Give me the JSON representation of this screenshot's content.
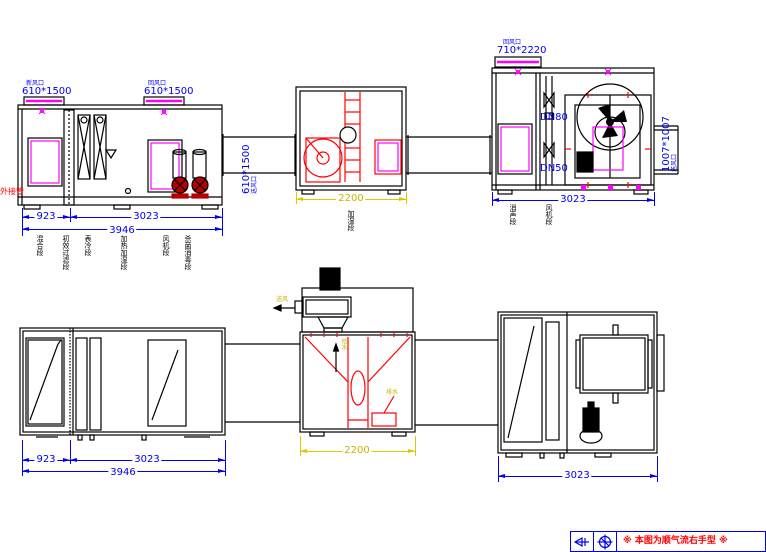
{
  "colors": {
    "dimension_blue": "#0000ee",
    "component_red": "#ff0000",
    "door_magenta": "#ff00ff",
    "dimension_yellow": "#ddc700",
    "pump_dark_red": "#b40000"
  },
  "elevation": {
    "left": {
      "vent1_name": "新风口",
      "vent1_size": "610*1500",
      "vent2_name": "回风口",
      "vent2_size": "610*1500",
      "duct_name": "送风口",
      "duct_size": "610*1500",
      "dim_a": "923",
      "dim_b": "3023",
      "dim_total": "3946",
      "side_note": "外接管",
      "sections": [
        "混合段",
        "初效过滤段",
        "表冷段",
        "加热加湿段",
        "风机段",
        "杀菌消毒段"
      ]
    },
    "middle": {
      "dim": "2200",
      "section": "加湿段"
    },
    "right": {
      "vent_name": "回风口",
      "vent_size": "710*2220",
      "pipe_top": "DN80",
      "pipe_bottom": "DN50",
      "outlet_name": "送风口",
      "outlet_size": "1007*1007",
      "dim": "3023",
      "sections": [
        "消声段",
        "风机段"
      ]
    }
  },
  "plan": {
    "left": {
      "dim_a": "923",
      "dim_b": "3023",
      "dim_total": "3946"
    },
    "middle": {
      "dim": "2200",
      "note_blower": "送风",
      "note_supply": "给水",
      "note_drain": "排水"
    },
    "right": {
      "dim": "3023"
    }
  },
  "title_block": {
    "note": "※  本图为顺气流右手型  ※"
  }
}
